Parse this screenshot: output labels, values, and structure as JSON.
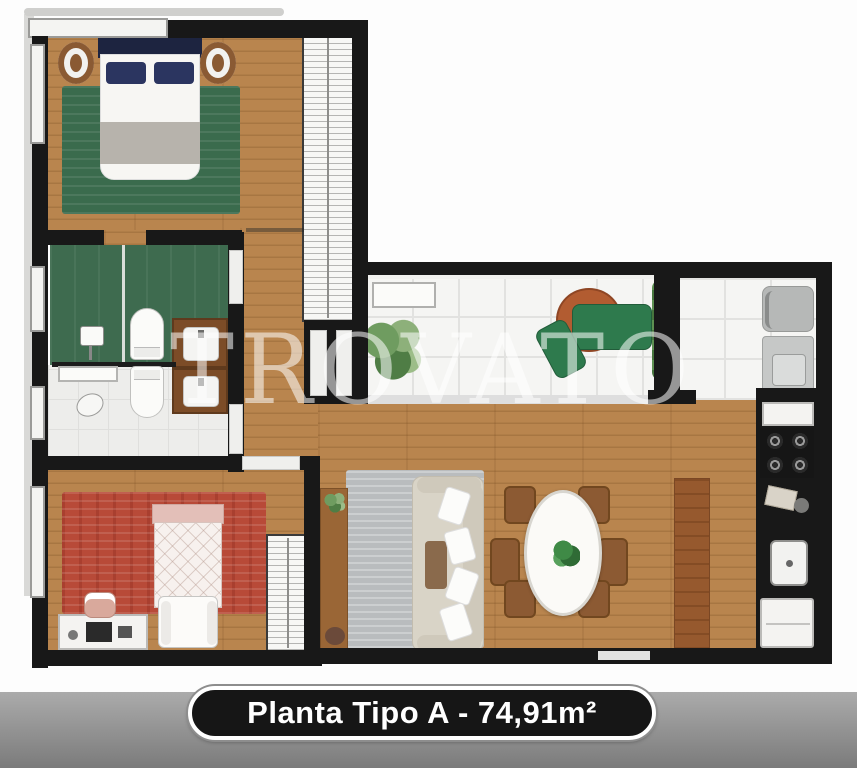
{
  "watermark": {
    "text": "TROVATO"
  },
  "footer": {
    "label": "Planta Tipo A - 74,91m²"
  },
  "colors": {
    "wall": "#181818",
    "wood": "#b9854e",
    "wood_dark": "#96592e",
    "tile": "#f5f5f3",
    "bath_green": "#3e6b4f",
    "rug_green": "#3a6b4d",
    "rug_red": "#b84a38",
    "rug_gray": "#b9bcbe",
    "sofa": "#d9d4c7",
    "chair": "#8c5a33",
    "navy": "#1d2440",
    "pill_bg": "#161616",
    "footer_top": "#ababab",
    "footer_bottom": "#7b7b7b"
  }
}
